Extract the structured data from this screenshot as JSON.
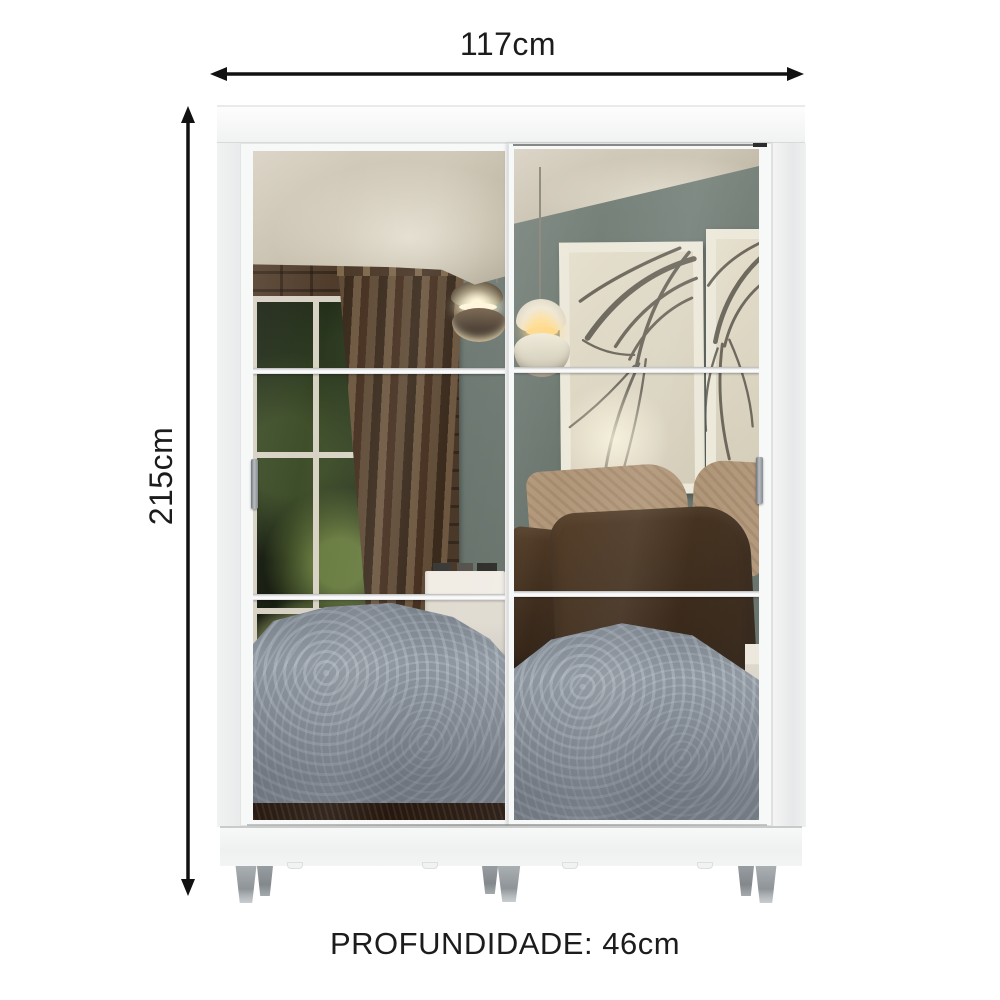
{
  "dimensions": {
    "width_label": "117cm",
    "height_label": "215cm",
    "depth_label": "PROFUNDIDADE: 46cm"
  },
  "icons": {
    "width_arrow": "double-headed-horizontal-arrow",
    "height_arrow": "double-headed-vertical-arrow"
  },
  "colors": {
    "text": "#1c1c1c",
    "arrow": "#111111",
    "ceiling_cream": "#c6beac",
    "wall_green": "#6e7972",
    "lattice_brown": "#483627",
    "curtain_brown": "#53422f",
    "garden_dark": "#161c10",
    "comforter_gray": "#8d959e",
    "pillow_dark": "#3c2b1c",
    "pillow_tan": "#b1977a",
    "floor_dark": "#241811",
    "frame_cream": "#ece8da",
    "lamp_glow": "#fff6dd"
  }
}
